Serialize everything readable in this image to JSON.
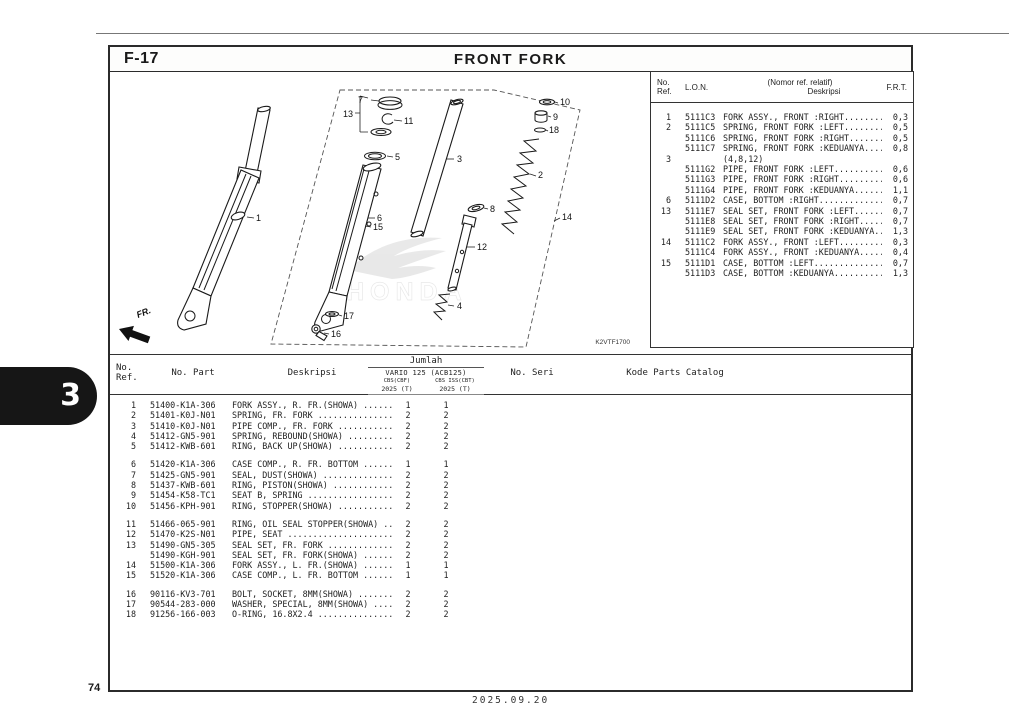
{
  "page": {
    "code": "F-17",
    "title": "FRONT FORK",
    "page_number": "74",
    "date": "2025.09.20",
    "section_tab": "3"
  },
  "lon_table": {
    "headers": {
      "ref_line1": "No.",
      "ref_line2": "Ref.",
      "lon": "L.O.N.",
      "desc_line1": "(Nomor ref. relatif)",
      "desc_line2": "Deskripsi",
      "frt": "F.R.T."
    },
    "rows": [
      {
        "ref": "1",
        "lon": "5111C3",
        "desc": "FORK ASSY., FRONT :RIGHT.........",
        "frt": "0,3"
      },
      {
        "ref": "2",
        "lon": "5111C5",
        "desc": "SPRING, FRONT FORK :LEFT.........",
        "frt": "0,5"
      },
      {
        "ref": "",
        "lon": "5111C6",
        "desc": "SPRING, FRONT FORK :RIGHT........",
        "frt": "0,5"
      },
      {
        "ref": "",
        "lon": "5111C7",
        "desc": "SPRING, FRONT FORK :KEDUANYA.....",
        "frt": "0,8"
      },
      {
        "ref": "3",
        "lon": "",
        "desc": "(4,8,12)",
        "frt": ""
      },
      {
        "ref": "",
        "lon": "5111G2",
        "desc": "PIPE, FRONT FORK :LEFT...........",
        "frt": "0,6"
      },
      {
        "ref": "",
        "lon": "5111G3",
        "desc": "PIPE, FRONT FORK :RIGHT..........",
        "frt": "0,6"
      },
      {
        "ref": "",
        "lon": "5111G4",
        "desc": "PIPE, FRONT FORK :KEDUANYA.......",
        "frt": "1,1"
      },
      {
        "ref": "6",
        "lon": "5111D2",
        "desc": "CASE, BOTTOM :RIGHT..............",
        "frt": "0,7"
      },
      {
        "ref": "13",
        "lon": "5111E7",
        "desc": "SEAL SET, FRONT FORK :LEFT.......",
        "frt": "0,7"
      },
      {
        "ref": "",
        "lon": "5111E8",
        "desc": "SEAL SET, FRONT FORK :RIGHT......",
        "frt": "0,7"
      },
      {
        "ref": "",
        "lon": "5111E9",
        "desc": "SEAL SET, FRONT FORK :KEDUANYA...",
        "frt": "1,3"
      },
      {
        "ref": "14",
        "lon": "5111C2",
        "desc": "FORK ASSY., FRONT :LEFT..........",
        "frt": "0,3"
      },
      {
        "ref": "",
        "lon": "5111C4",
        "desc": "FORK ASSY., FRONT :KEDUANYA......",
        "frt": "0,4"
      },
      {
        "ref": "15",
        "lon": "5111D1",
        "desc": "CASE, BOTTOM :LEFT...............",
        "frt": "0,7"
      },
      {
        "ref": "",
        "lon": "5111D3",
        "desc": "CASE, BOTTOM :KEDUANYA...........",
        "frt": "1,3"
      }
    ]
  },
  "parts_table": {
    "headers": {
      "ref_line1": "No.",
      "ref_line2": "Ref.",
      "part": "No. Part",
      "desc": "Deskripsi",
      "jumlah": "Jumlah",
      "model": "VARIO 125 (ACB125)",
      "sub1": "CBS(CBF)",
      "sub2": "CBS ISS(CBT)",
      "year1": "2025 (T)",
      "year2": "2025 (T)",
      "seri": "No. Seri",
      "kode": "Kode Parts Catalog"
    },
    "groups": [
      [
        {
          "ref": "1",
          "part": "51400-K1A-306",
          "desc": "FORK ASSY., R. FR.(SHOWA) ......",
          "q1": "1",
          "q2": "1"
        },
        {
          "ref": "2",
          "part": "51401-K0J-N01",
          "desc": "SPRING, FR. FORK ...............",
          "q1": "2",
          "q2": "2"
        },
        {
          "ref": "3",
          "part": "51410-K0J-N01",
          "desc": "PIPE COMP., FR. FORK ...........",
          "q1": "2",
          "q2": "2"
        },
        {
          "ref": "4",
          "part": "51412-GN5-901",
          "desc": "SPRING, REBOUND(SHOWA) .........",
          "q1": "2",
          "q2": "2"
        },
        {
          "ref": "5",
          "part": "51412-KWB-601",
          "desc": "RING, BACK UP(SHOWA) ...........",
          "q1": "2",
          "q2": "2"
        }
      ],
      [
        {
          "ref": "6",
          "part": "51420-K1A-306",
          "desc": "CASE COMP., R. FR. BOTTOM ......",
          "q1": "1",
          "q2": "1"
        },
        {
          "ref": "7",
          "part": "51425-GN5-901",
          "desc": "SEAL, DUST(SHOWA) ..............",
          "q1": "2",
          "q2": "2"
        },
        {
          "ref": "8",
          "part": "51437-KWB-601",
          "desc": "RING, PISTON(SHOWA) ............",
          "q1": "2",
          "q2": "2"
        },
        {
          "ref": "9",
          "part": "51454-K58-TC1",
          "desc": "SEAT B, SPRING .................",
          "q1": "2",
          "q2": "2"
        },
        {
          "ref": "10",
          "part": "51456-KPH-901",
          "desc": "RING, STOPPER(SHOWA) ...........",
          "q1": "2",
          "q2": "2"
        }
      ],
      [
        {
          "ref": "11",
          "part": "51466-065-901",
          "desc": "RING, OIL SEAL STOPPER(SHOWA) ..",
          "q1": "2",
          "q2": "2"
        },
        {
          "ref": "12",
          "part": "51470-K2S-N01",
          "desc": "PIPE, SEAT .....................",
          "q1": "2",
          "q2": "2"
        },
        {
          "ref": "13",
          "part": "51490-GN5-305",
          "desc": "SEAL SET, FR. FORK .............",
          "q1": "2",
          "q2": "2"
        },
        {
          "ref": "",
          "part": "51490-KGH-901",
          "desc": "SEAL SET, FR. FORK(SHOWA) ......",
          "q1": "2",
          "q2": "2"
        },
        {
          "ref": "14",
          "part": "51500-K1A-306",
          "desc": "FORK ASSY., L. FR.(SHOWA) ......",
          "q1": "1",
          "q2": "1"
        },
        {
          "ref": "15",
          "part": "51520-K1A-306",
          "desc": "CASE COMP., L. FR. BOTTOM ......",
          "q1": "1",
          "q2": "1"
        }
      ],
      [
        {
          "ref": "16",
          "part": "90116-KV3-701",
          "desc": "BOLT, SOCKET, 8MM(SHOWA) .......",
          "q1": "2",
          "q2": "2"
        },
        {
          "ref": "17",
          "part": "90544-283-000",
          "desc": "WASHER, SPECIAL, 8MM(SHOWA) ....",
          "q1": "2",
          "q2": "2"
        },
        {
          "ref": "18",
          "part": "91256-166-003",
          "desc": "O-RING, 16.8X2.4 ...............",
          "q1": "2",
          "q2": "2"
        }
      ]
    ]
  },
  "diagram": {
    "code": "K2VTF1700",
    "fr_label": "FR.",
    "watermark": "HONDA",
    "callouts": {
      "n1": "1",
      "n2": "2",
      "n3": "3",
      "n4": "4",
      "n5": "5",
      "n6": "6",
      "n7": "7",
      "n8": "8",
      "n9": "9",
      "n10": "10",
      "n11": "11",
      "n12": "12",
      "n13": "13",
      "n14": "14",
      "n15": "15",
      "n16": "16",
      "n17": "17",
      "n18": "18"
    }
  }
}
